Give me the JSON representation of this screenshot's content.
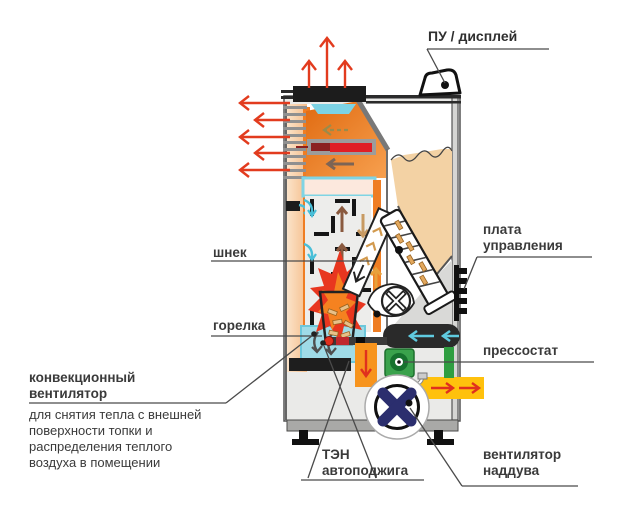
{
  "diagram": {
    "labels": {
      "display": "ПУ / дисплей",
      "auger": "шнек",
      "burner": "горелка",
      "convection_fan": "конвекционный вентилятор",
      "convection_fan_note": "для снятия тепла с внешней поверхности топки и распределения теплого воздуха в помещении",
      "ignition_heater": "ТЭН автоподжига",
      "control_board": "плата управления",
      "pressure_switch": "прессостат",
      "blower_fan": "вентилятор наддува"
    },
    "colors": {
      "arrow_red": "#e23b1e",
      "flame_outer": "#e8361f",
      "flame_inner": "#f58220",
      "chamber_orange": "#ed7d21",
      "hot_strip": "#ef7d23",
      "convection_peach": "#f8cfa6",
      "water_cyan": "#9fdbe7",
      "cyan_accent": "#5fcbe0",
      "pellet_beige": "#f3d2a4",
      "duct_yellow": "#ffc10d",
      "duct_orange": "#f7941d",
      "pressure_switch_green": "#3aa24c",
      "fan_navy": "#2b2e6e",
      "casing_grey": "#eaeae8",
      "line_dark": "#3a3a3a"
    }
  }
}
